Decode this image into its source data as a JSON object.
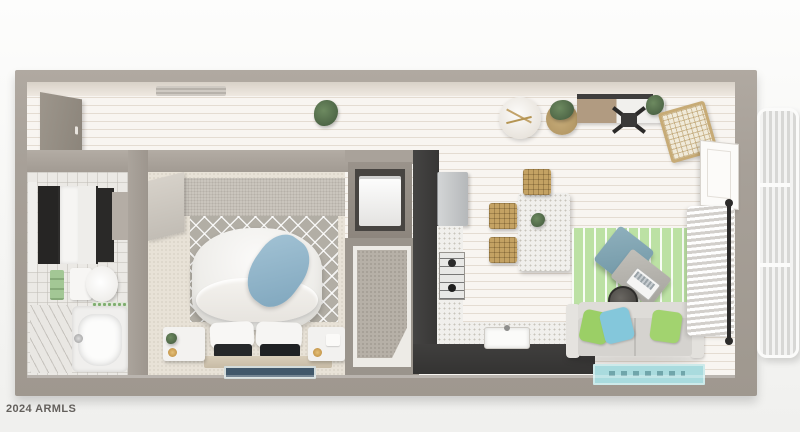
{
  "watermark": {
    "text": "2024 ARMLS"
  },
  "scene": {
    "type": "3d-dollhouse-floorplan-render",
    "rooms": {
      "bathroom": [
        "mirror-cabinet-vanity",
        "toilet",
        "bathtub",
        "green-towels",
        "green-mosaic-strip"
      ],
      "bedroom": [
        "bed-duvet",
        "blue-throw",
        "white-pillows",
        "dark-accent-pillows",
        "trellis-rug",
        "nightstand-left",
        "nightstand-right",
        "runner-rug",
        "textured-accent-wall"
      ],
      "closets": [
        "laundry-closet-washer",
        "walk-in-closet-carpet"
      ],
      "kitchen": [
        "refrigerator",
        "dark-cabinet-run",
        "gas-cooktop",
        "farmhouse-sink",
        "speckled-counter"
      ],
      "dining": [
        "terrazzo-table",
        "woven-stools",
        "table-plant"
      ],
      "entry_hall": [
        "entry-door",
        "ceiling-vent",
        "floor-plant",
        "round-side-table",
        "basket-plant",
        "console-desk",
        "office-chair",
        "desk-plant",
        "rattan-chair"
      ],
      "living": [
        "green-striped-rug",
        "blue-armchair",
        "ottoman",
        "laptop",
        "round-side-table-dark",
        "gray-sofa",
        "green-pillow",
        "blue-pillow",
        "teal-rug",
        "sheer-curtains",
        "curtain-rod",
        "white-door",
        "security-screen-door"
      ]
    }
  },
  "palette": {
    "background": "#f6f6f4",
    "wall_taupe": "#a7a098",
    "wood_floor": "#f1ebe3",
    "bedroom_carpet": "#e8e2d7",
    "cabinet_dark": "#3a3938",
    "counter_speckle": "#f0efec",
    "stool_tan": "#c4a263",
    "rug_green": "#bce1a4",
    "rug_teal": "#a9dbde",
    "pillow_green": "#9bcf66",
    "pillow_blue": "#84c7db",
    "throw_blue": "#8db2c8",
    "towel_green": "#a3c795",
    "armchair_blue": "#7fa2b2"
  }
}
